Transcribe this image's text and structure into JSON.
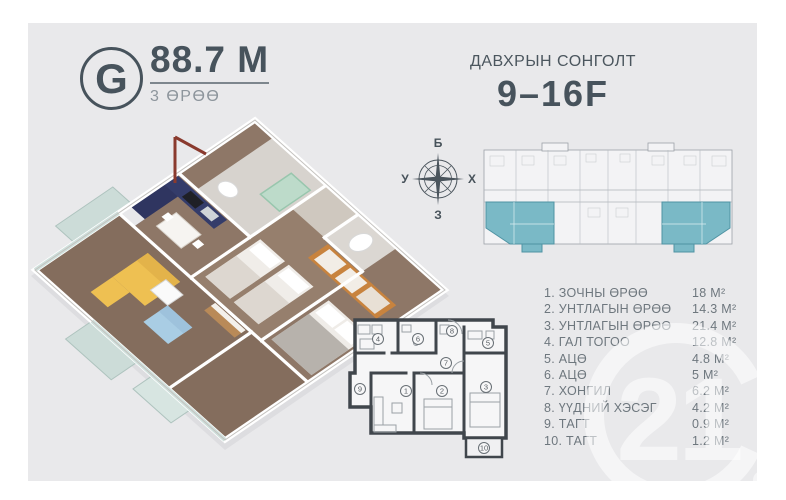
{
  "header": {
    "unit_letter": "G",
    "area_value": "88.7 M",
    "rooms_label": "3 ӨРӨӨ",
    "floor_select_label": "ДАВХРЫН СОНГОЛТ",
    "floor_range": "9–16F"
  },
  "compass": {
    "top": "Б",
    "left": "У",
    "right": "Х",
    "bottom": "З"
  },
  "room_list": [
    {
      "label": "1. ЗОЧНЫ ӨРӨӨ",
      "area": "18 M²"
    },
    {
      "label": "2. УНТЛАГЫН ӨРӨӨ",
      "area": "14.3 M²"
    },
    {
      "label": "3. УНТЛАГЫН ӨРӨӨ",
      "area": "21.4 M²"
    },
    {
      "label": "4. ГАЛ ТОГОО",
      "area": "12.8 M²"
    },
    {
      "label": "5. АЦӨ",
      "area": "4.8 M²"
    },
    {
      "label": "6. АЦӨ",
      "area": "5 M²"
    },
    {
      "label": "7. ХОНГИЛ",
      "area": "6.2 M²"
    },
    {
      "label": "8. ҮҮДНИЙ ХЭСЭГ",
      "area": "4.2 M²"
    },
    {
      "label": "9. ТАГТ",
      "area": "0.9 M²"
    },
    {
      "label": "10. ТАГТ",
      "area": "1.2 M²"
    }
  ],
  "floorplan_2d": {
    "numbers": [
      "1",
      "2",
      "3",
      "4",
      "5",
      "6",
      "7",
      "8",
      "9",
      "10"
    ]
  },
  "watermark": {
    "text": "21"
  },
  "colors": {
    "card_background": "#e9e9eb",
    "accent_text": "#47535c",
    "muted_text": "#8d959c",
    "list_text": "#6e777e",
    "unit_highlight_teal": "#7ab9c6",
    "wood_floor": "#8e7767",
    "sofa_yellow": "#eec052",
    "sofa_blue": "#a9cde4",
    "wardrobe_orange": "#c8833e",
    "kitchen_navy": "#2f3560",
    "shower_glass_green": "#b9ddca",
    "door_frame_red": "#8a3a2e"
  }
}
